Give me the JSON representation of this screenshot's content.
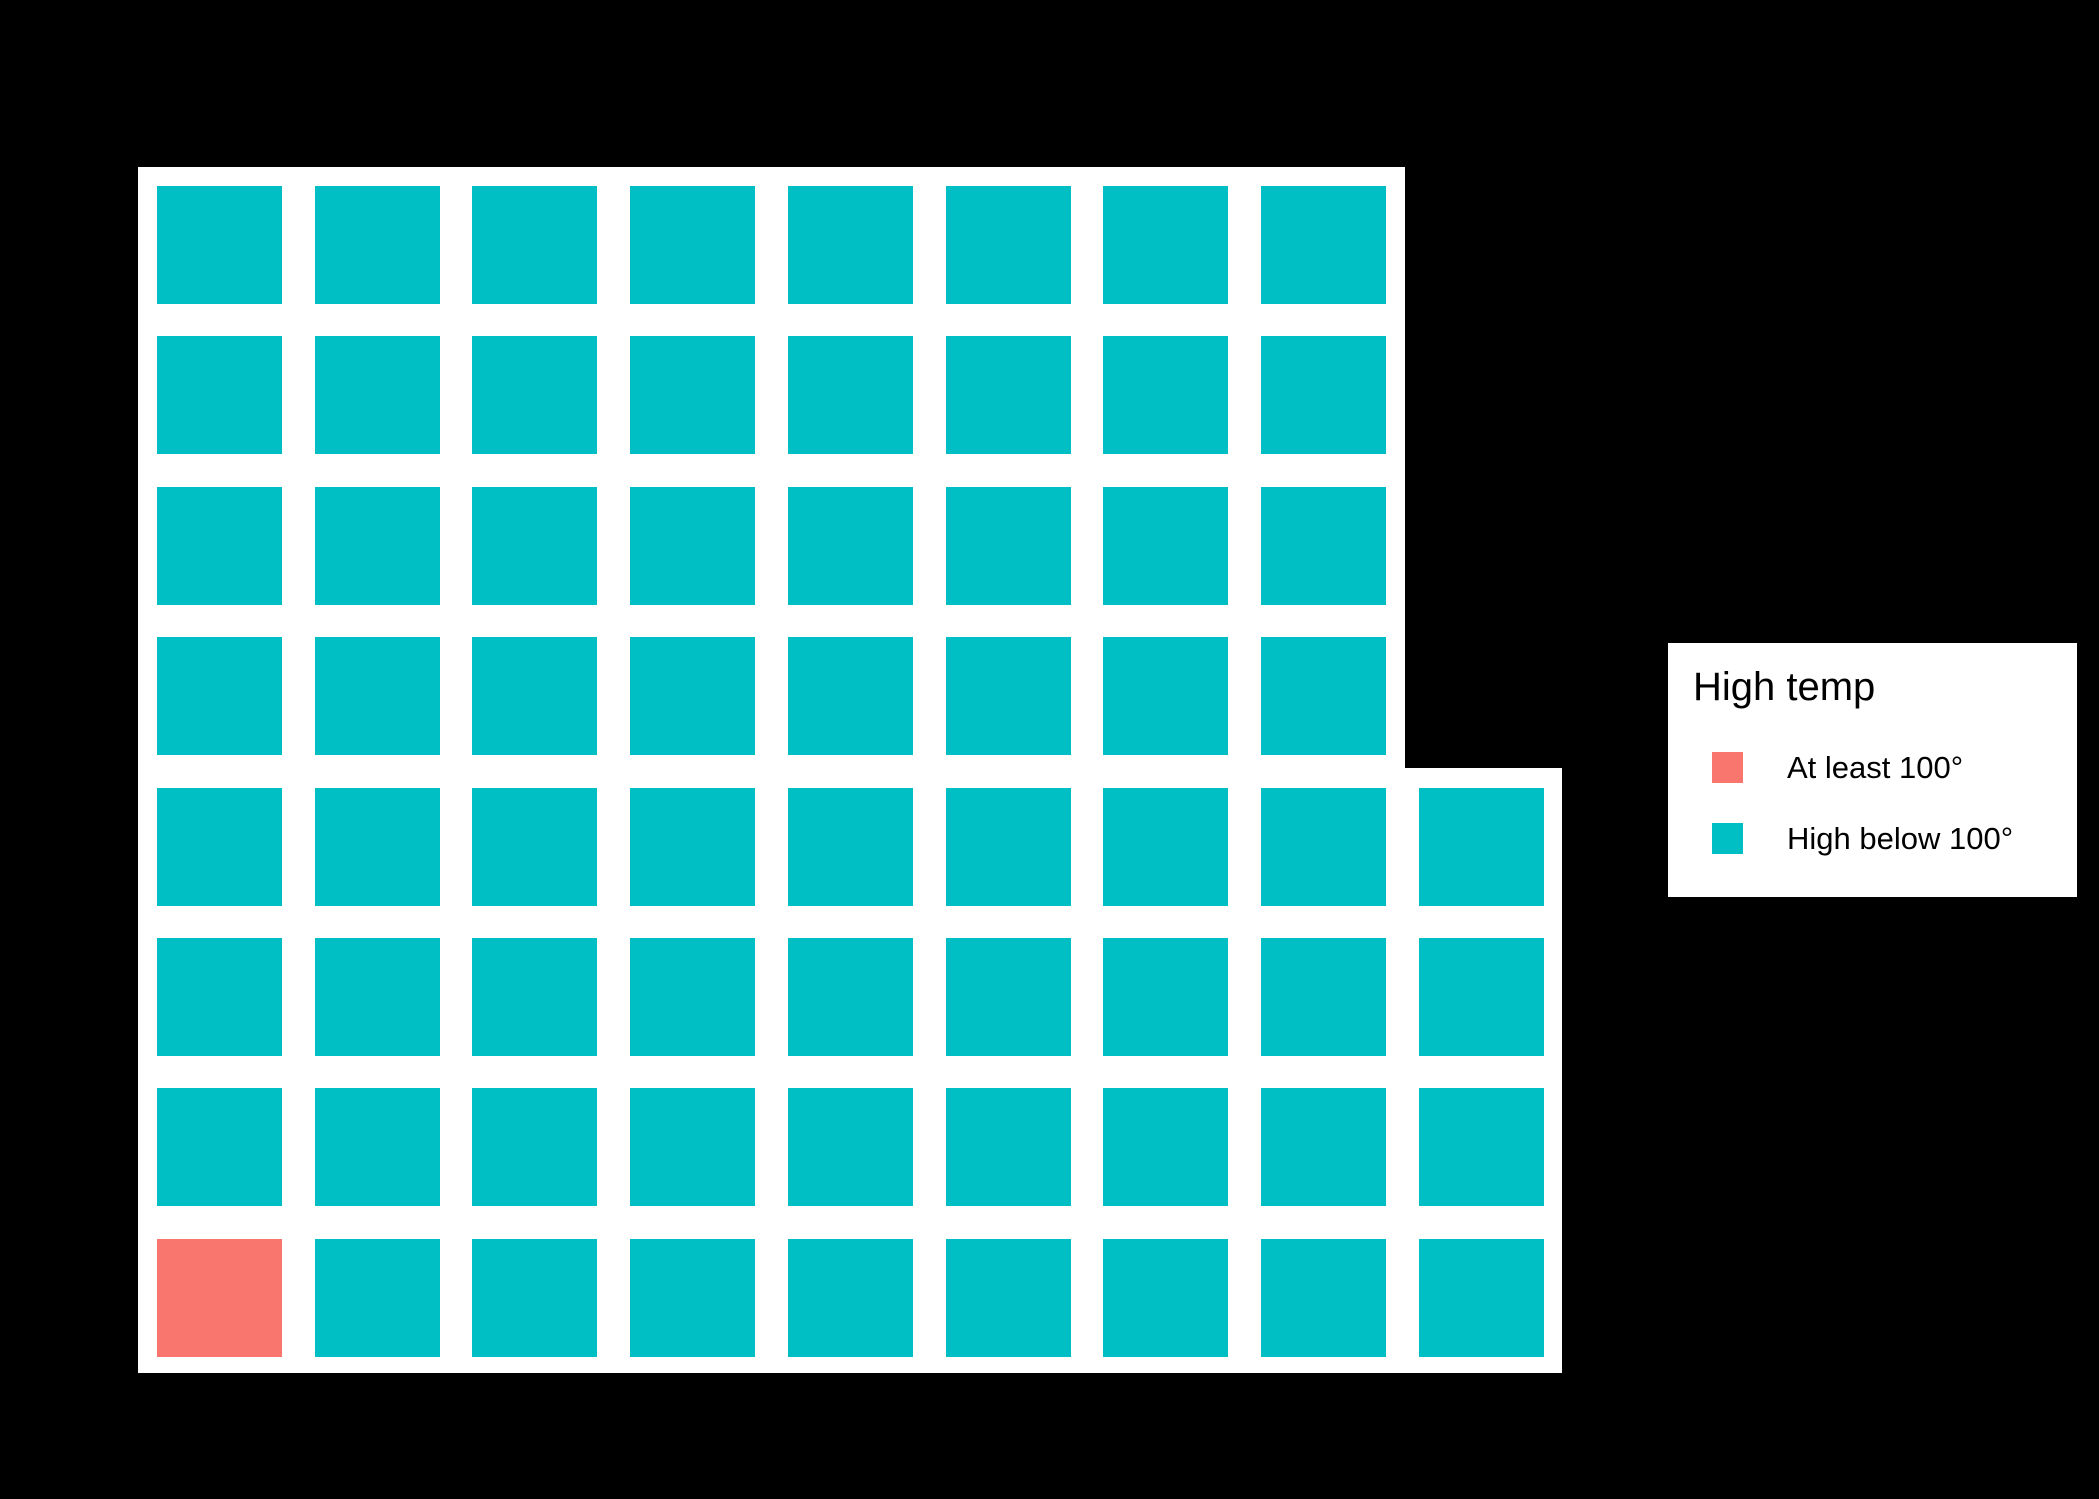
{
  "canvas": {
    "background": "#000000",
    "width": 2099,
    "height": 1499
  },
  "legend": {
    "title": "High temp",
    "position": "right",
    "background": "#ffffff",
    "entries": [
      {
        "label": "At least 100°",
        "color": "#F8766D"
      },
      {
        "label": "High below 100°",
        "color": "#00BFC4"
      }
    ]
  },
  "chart_data": {
    "type": "waffle",
    "legend_title": "High temp",
    "categories": [
      "At least 100°",
      "High below 100°"
    ],
    "colors": [
      "#F8766D",
      "#00BFC4"
    ],
    "counts": [
      1,
      67
    ],
    "total_squares": 68,
    "row_counts_top_to_bottom": [
      8,
      8,
      8,
      8,
      9,
      9,
      9,
      9
    ],
    "grid_rows_top_to_bottom": [
      "tttttttt",
      "tttttttt",
      "tttttttt",
      "tttttttt",
      "ttttttttt",
      "ttttttttt",
      "ttttttttt",
      "rtttttttt"
    ],
    "cell_category_index": {
      "r": 0,
      "t": 1
    },
    "highlight_cell": {
      "row_from_top": 8,
      "col": 1,
      "category": "At least 100°"
    },
    "panel_background": "#ffffff",
    "page_background": "#000000",
    "legend_position": "right"
  }
}
